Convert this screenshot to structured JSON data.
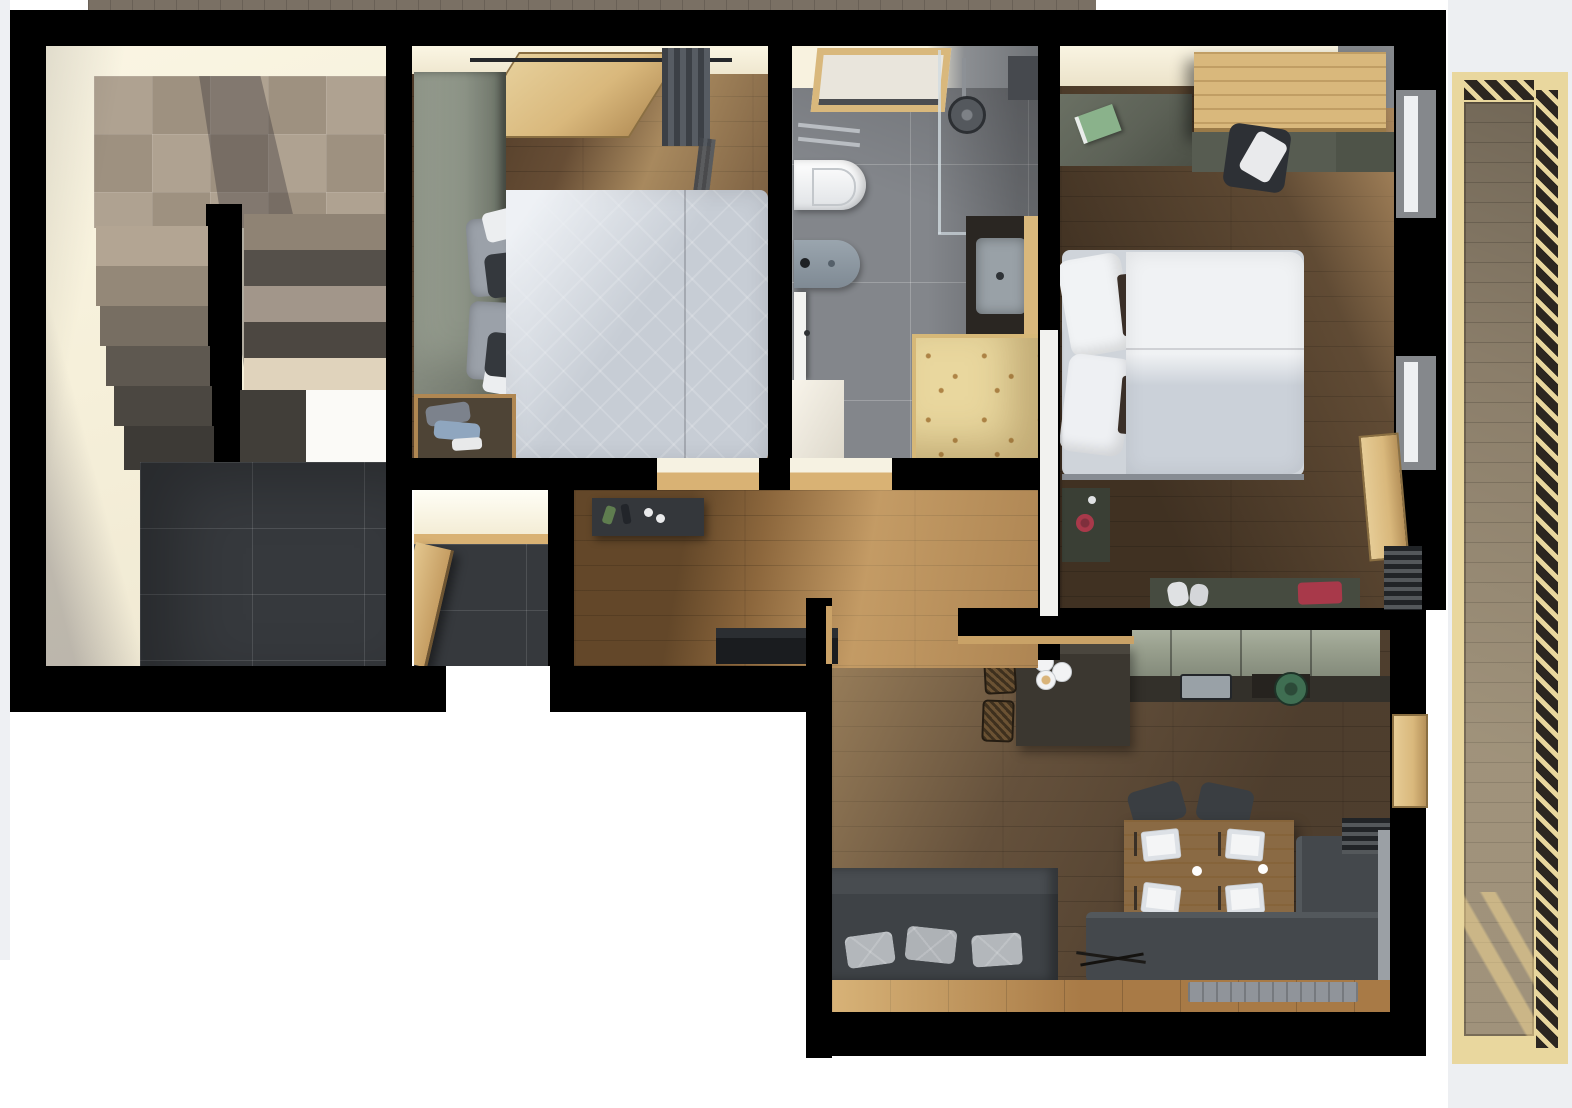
{
  "meta": {
    "kind": "top-down 3D rendered apartment floor plan",
    "visible_text": "none"
  },
  "palette": {
    "wall": "#000000",
    "cream": "#f6f0da",
    "white": "#ffffff",
    "side": "#edeff2",
    "stone": "#ab9d8b",
    "tiledark": "#36393d",
    "bath": "#83868b",
    "woodb1": "#6e5339",
    "woodb2": "#53402d",
    "woodh": "#9c7344",
    "woodl": "#5d4a37",
    "sage": "#8b9285",
    "saged": "#5d6257",
    "sagek": "#9aa18f",
    "pine": "#e9d79e",
    "pinem": "#d9b87c",
    "pinet": "#d9b274",
    "deck": "#8b7e6a",
    "duvet": "#c7cdd5",
    "pillowd": "#34383d",
    "sofa": "#3e4246",
    "benchc": "#44484c",
    "tablew": "#8a6a44",
    "red": "#a8394a",
    "steel": "#b9bdc2",
    "stool": "#6b5233",
    "counter": "#33302a",
    "island": "#3b3730",
    "rug": "#90949a",
    "sink": "#99a1a7",
    "greenpot": "#3f6e52"
  },
  "rooms": [
    {
      "id": "stairwell",
      "items": [
        "tiled-landing",
        "upper-stair-flight",
        "lower-stair-flight",
        "dark-tile-floor"
      ]
    },
    {
      "id": "bedroom-small",
      "items": [
        "wardrobe",
        "double-bed",
        "luggage-bench",
        "entry-door",
        "curtain"
      ]
    },
    {
      "id": "bathroom",
      "items": [
        "window",
        "towel-rail",
        "wall-hung-toilet",
        "bidet",
        "shower",
        "vanity-sink",
        "sauna-cabinet",
        "door"
      ]
    },
    {
      "id": "bedroom-master",
      "items": [
        "desk",
        "overhead-cabinet",
        "chair-with-clothes",
        "double-bed",
        "nightstand",
        "storage-bench",
        "balcony-door",
        "radiator",
        "windows"
      ]
    },
    {
      "id": "entry-closet",
      "items": [
        "door",
        "dark-tile-floor"
      ]
    },
    {
      "id": "hallway",
      "items": [
        "sideboard",
        "shoe-bench"
      ]
    },
    {
      "id": "living-kitchen",
      "items": [
        "kitchen-cabinets",
        "counter-sink",
        "cooktop-pot",
        "island-counter",
        "bar-stools",
        "dining-table",
        "dining-chairs",
        "corner-bench",
        "sofa",
        "rug",
        "radiator",
        "balcony-door"
      ]
    },
    {
      "id": "balcony",
      "items": [
        "wood-deck",
        "slatted-railing"
      ]
    }
  ]
}
